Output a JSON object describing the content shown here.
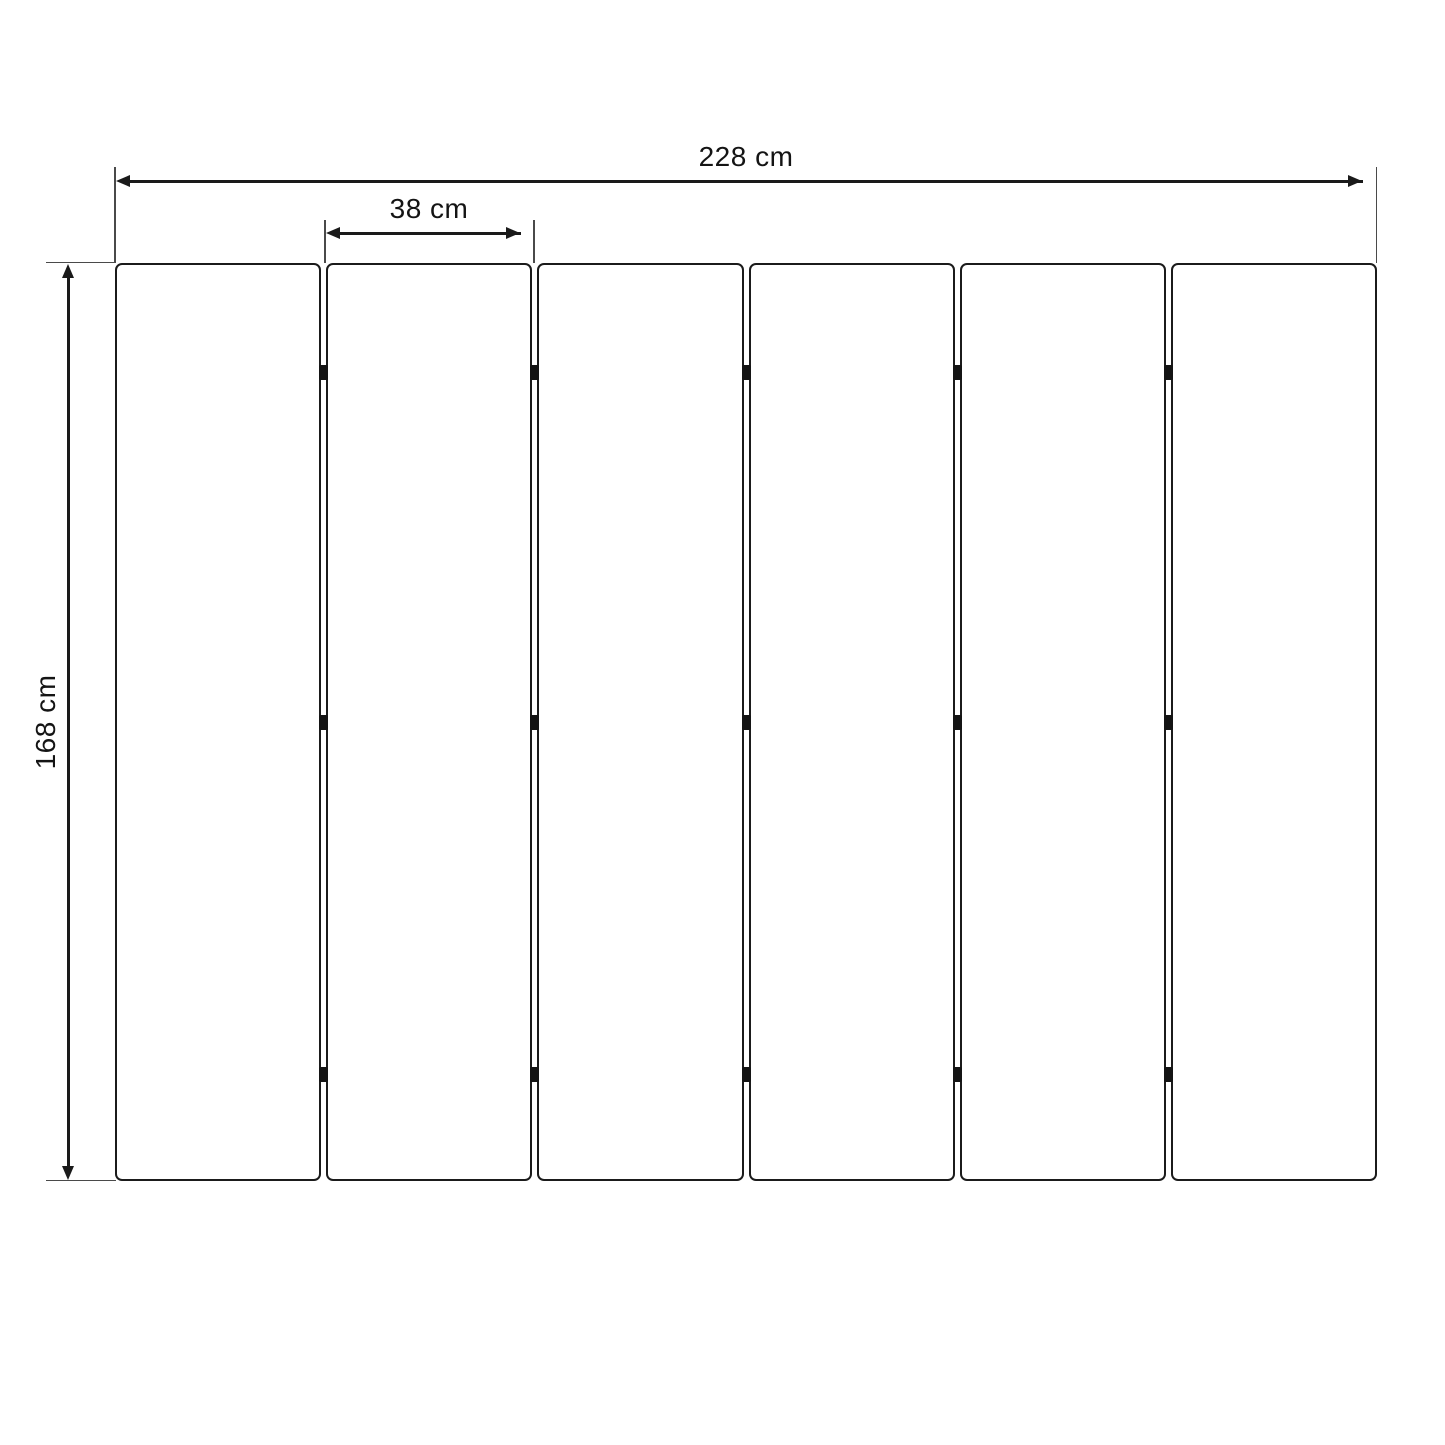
{
  "diagram": {
    "total_width_label": "228 cm",
    "panel_width_label": "38 cm",
    "height_label": "168 cm",
    "panel_count": 6,
    "hinges_per_gap": 3,
    "colors": {
      "background": "#ffffff",
      "dimension_line": "#1a1a1a",
      "extension_line": "#4a4a4a",
      "panel_border": "#1b1b1b",
      "panel_fill": "#ffffff",
      "hinge": "#141414",
      "text": "#141414"
    }
  }
}
